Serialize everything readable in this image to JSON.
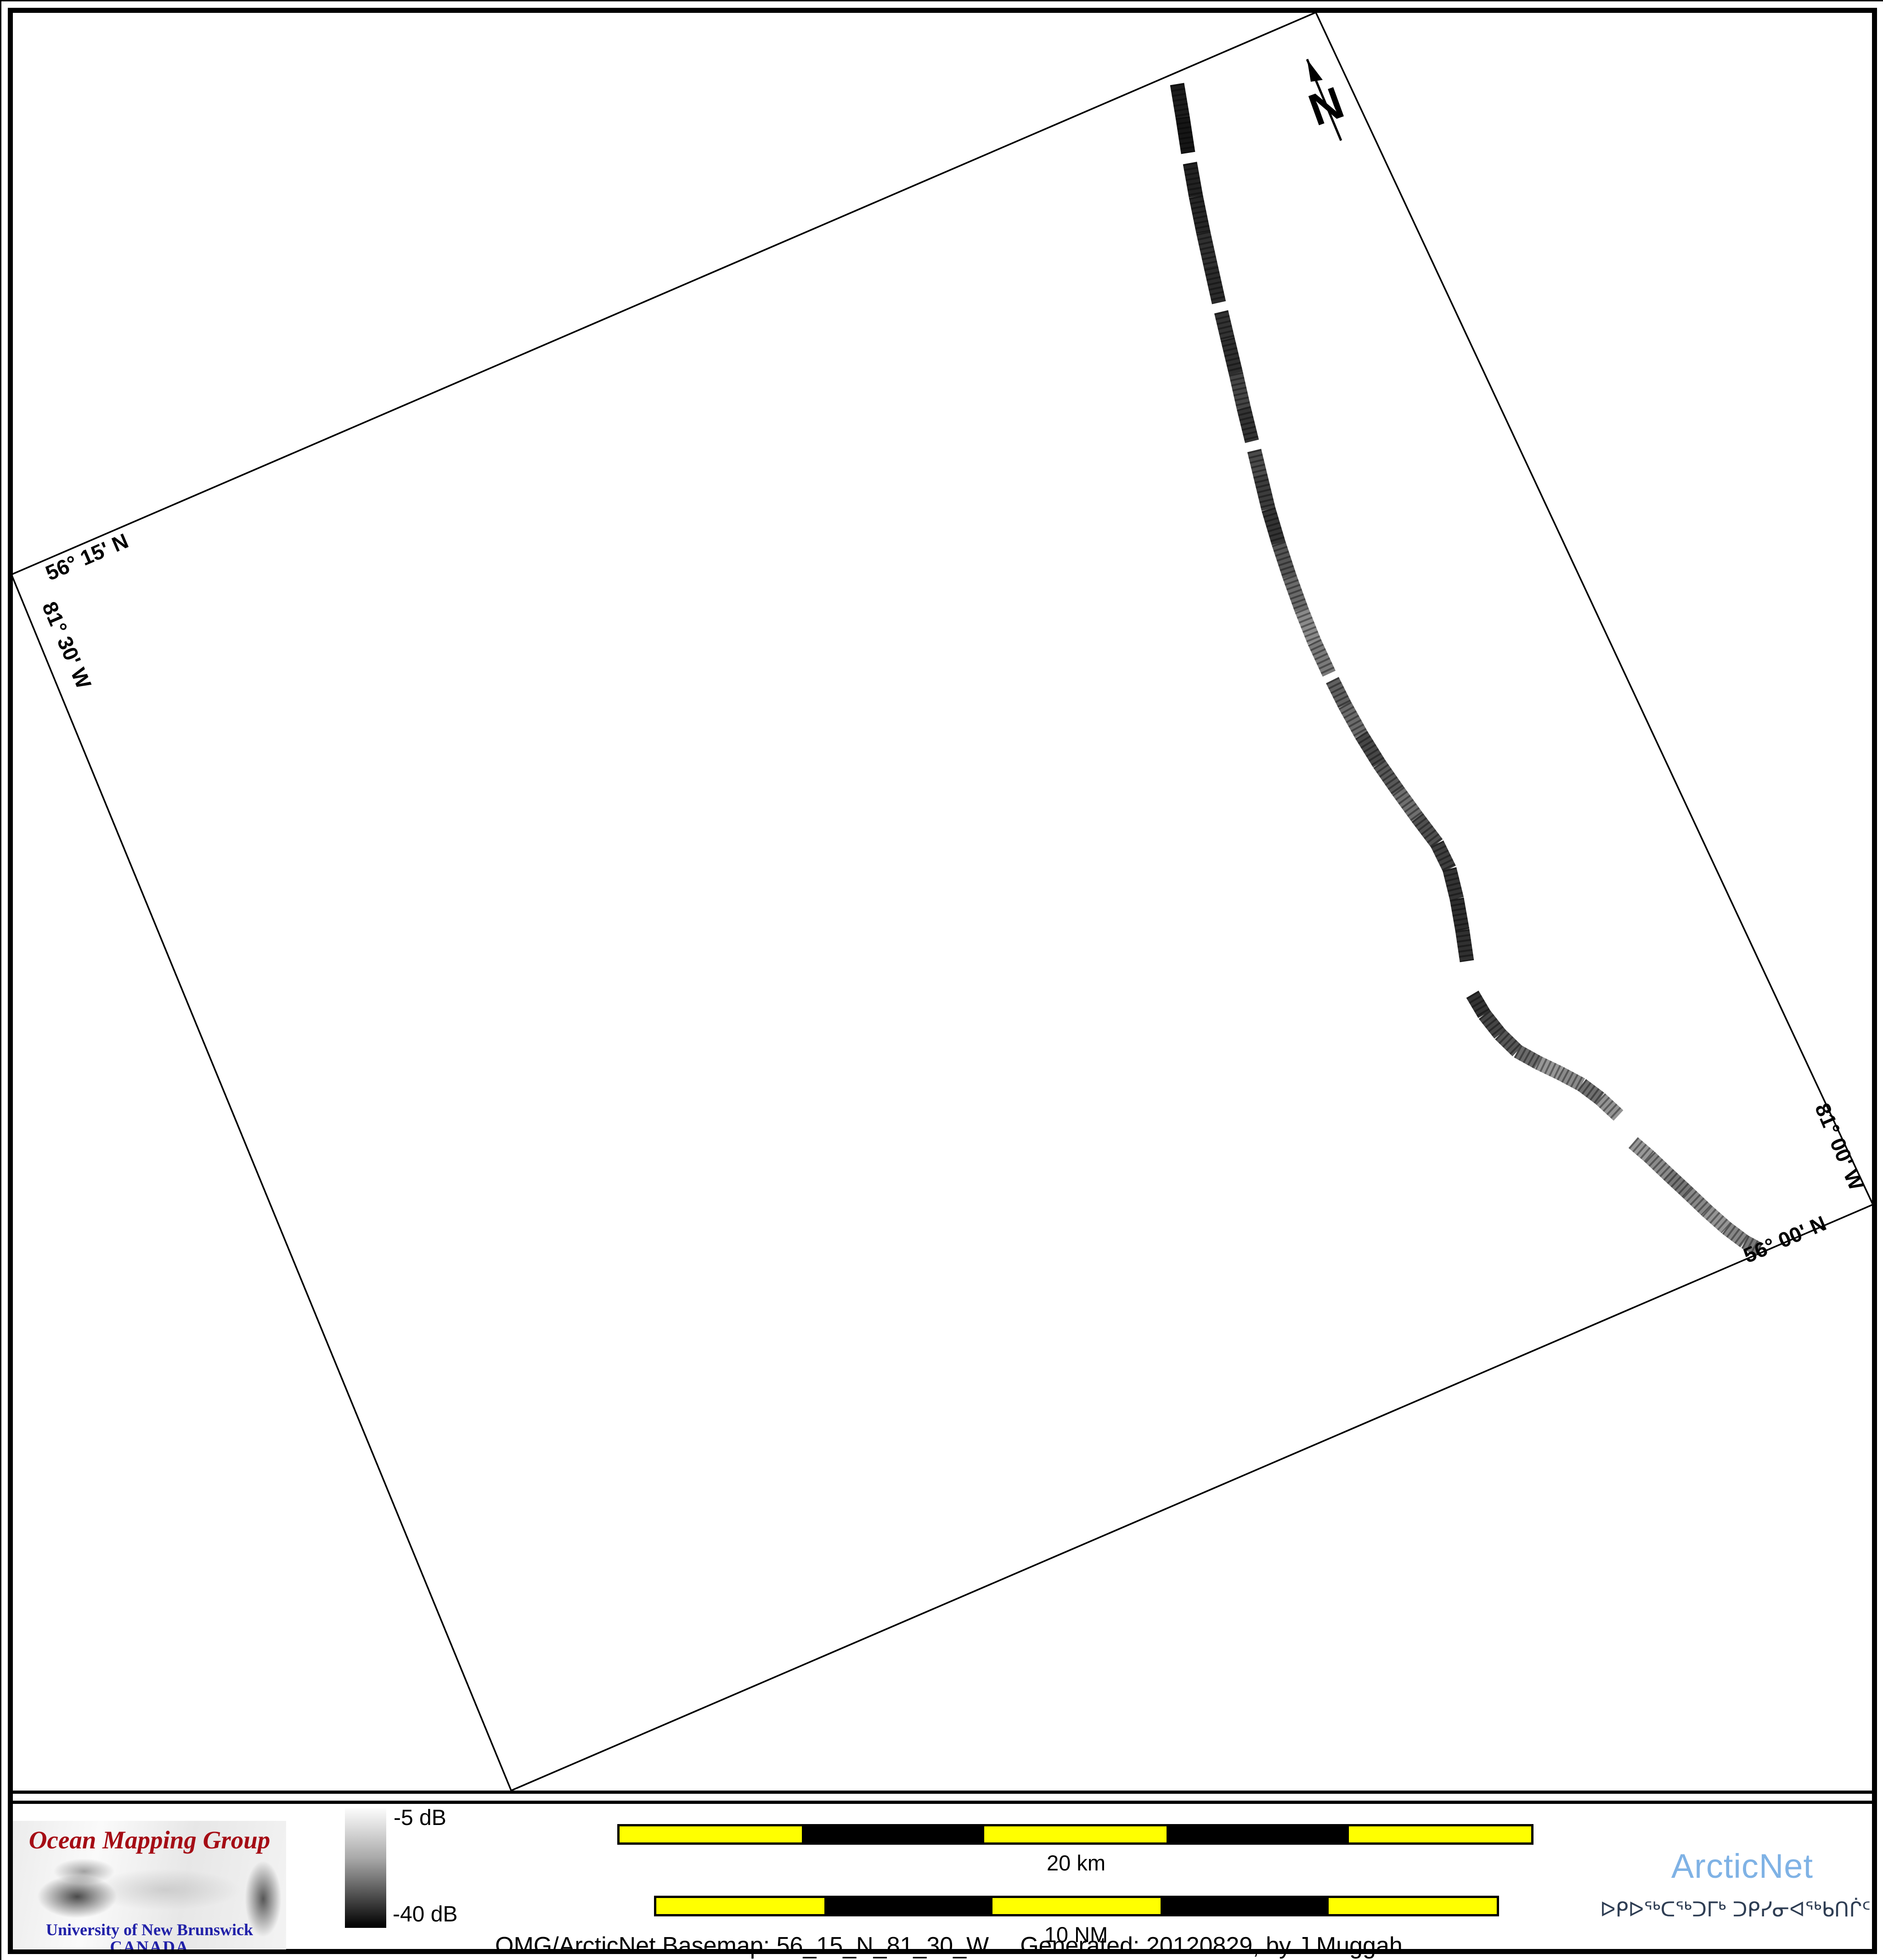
{
  "map": {
    "labels": {
      "top_left_lat": "56° 15' N",
      "left_lon": "81° 30' W",
      "right_lon": "81° 00' W",
      "bottom_right_lat": "56° 00' N"
    },
    "north_label": "N",
    "boundary": {
      "corners": [
        [
          22,
          1248
        ],
        [
          2862,
          24
        ],
        [
          4075,
          2620
        ],
        [
          1110,
          3896
        ]
      ],
      "stroke": "#000000",
      "stroke_width": 3.5
    },
    "track": {
      "description": "multibeam backscatter survey track",
      "width": 31,
      "points": [
        [
          2560,
          180,
          "#1c1c1c",
          0
        ],
        [
          2572,
          252,
          "#161616",
          0
        ],
        [
          2584,
          330,
          "#2a2a2a",
          1
        ],
        [
          2588,
          352,
          "#222222",
          0
        ],
        [
          2601,
          425,
          "#262626",
          0
        ],
        [
          2617,
          503,
          "#303030",
          0
        ],
        [
          2634,
          580,
          "#2b2b2b",
          0
        ],
        [
          2651,
          656,
          "#3a3a3a",
          1
        ],
        [
          2656,
          676,
          "#333333",
          0
        ],
        [
          2670,
          735,
          "#2e2e2e",
          0
        ],
        [
          2688,
          810,
          "#454545",
          0
        ],
        [
          2705,
          885,
          "#333333",
          0
        ],
        [
          2723,
          958,
          "#575757",
          1
        ],
        [
          2728,
          978,
          "#4a4a4a",
          0
        ],
        [
          2741,
          1032,
          "#3c3c3c",
          0
        ],
        [
          2759,
          1106,
          "#333333",
          0
        ],
        [
          2781,
          1180,
          "#555555",
          0
        ],
        [
          2805,
          1253,
          "#6a6a6a",
          0
        ],
        [
          2831,
          1325,
          "#8a8a8a",
          0
        ],
        [
          2859,
          1395,
          "#7a7a7a",
          0
        ],
        [
          2891,
          1464,
          "#565656",
          1
        ],
        [
          2898,
          1478,
          "#606060",
          0
        ],
        [
          2925,
          1532,
          "#6b6b6b",
          0
        ],
        [
          2961,
          1597,
          "#474747",
          0
        ],
        [
          3000,
          1660,
          "#585858",
          0
        ],
        [
          3041,
          1719,
          "#6f6f6f",
          0
        ],
        [
          3083,
          1777,
          "#4f4f4f",
          0
        ],
        [
          3126,
          1834,
          "#3f3f3f",
          0
        ],
        [
          3153,
          1889,
          "#333333",
          0
        ],
        [
          3169,
          1954,
          "#2d2d2d",
          0
        ],
        [
          3181,
          2022,
          "#303030",
          0
        ],
        [
          3191,
          2090,
          "#202020",
          1
        ],
        [
          3203,
          2162,
          "#333333",
          0
        ],
        [
          3229,
          2206,
          "#454545",
          0
        ],
        [
          3263,
          2249,
          "#565656",
          0
        ],
        [
          3301,
          2286,
          "#6a6a6a",
          0
        ],
        [
          3346,
          2311,
          "#979797",
          0
        ],
        [
          3394,
          2334,
          "#8a8a8a",
          0
        ],
        [
          3441,
          2359,
          "#6f6f6f",
          0
        ],
        [
          3481,
          2389,
          "#949494",
          0
        ],
        [
          3521,
          2426,
          "#858585",
          1
        ],
        [
          3536,
          2458,
          "#909090",
          1
        ],
        [
          3553,
          2485,
          "#989898",
          0
        ],
        [
          3589,
          2516,
          "#8b8b8b",
          0
        ],
        [
          3629,
          2554,
          "#777777",
          0
        ],
        [
          3671,
          2593,
          "#888888",
          0
        ],
        [
          3713,
          2633,
          "#959595",
          0
        ],
        [
          3756,
          2671,
          "#878787",
          0
        ],
        [
          3796,
          2701,
          "#7a7a7a",
          0
        ],
        [
          3828,
          2718,
          "#6a6a6a",
          0
        ]
      ]
    },
    "north_arrow": {
      "line": [
        2843,
        126,
        2917,
        303
      ],
      "head": [
        [
          2843,
          126
        ],
        [
          2877,
          171
        ],
        [
          2851,
          175
        ]
      ]
    }
  },
  "footer": {
    "logo_omg": {
      "title": "Ocean Mapping Group",
      "title_color": "#a50d15",
      "subtitle": "University of New Brunswick",
      "country": "CANADA",
      "subtitle_color": "#2121a8"
    },
    "colorbar": {
      "top_label": "-5 dB",
      "bottom_label": "-40 dB",
      "top_value": -5,
      "bottom_value": -40,
      "unit": "dB",
      "gradient": [
        "#fbfbfb",
        "#000000"
      ]
    },
    "scalebar_km": {
      "label": "20 km",
      "length": 20,
      "unit": "km",
      "segments": 5,
      "colors": [
        "#ffff00",
        "#000000"
      ]
    },
    "scalebar_nm": {
      "label": "10 NM",
      "length": 10,
      "unit": "NM",
      "segments": 5,
      "colors": [
        "#ffff00",
        "#000000"
      ]
    },
    "caption_left": "OMG/ArcticNet Basemap: 56_15_N_81_30_W",
    "caption_right": "Generated: 20120829, by J.Muggah",
    "logo_arcticnet": {
      "name": "ArcticNet",
      "name_color": "#7fb2e5",
      "inuktitut": "ᐅᑭᐅᖅᑕᖅᑐᒥᒃ ᑐᑭᓯᓂᐊᖅᑲᑎᒌᑦ",
      "inuktitut_color": "#2f3e54"
    }
  }
}
